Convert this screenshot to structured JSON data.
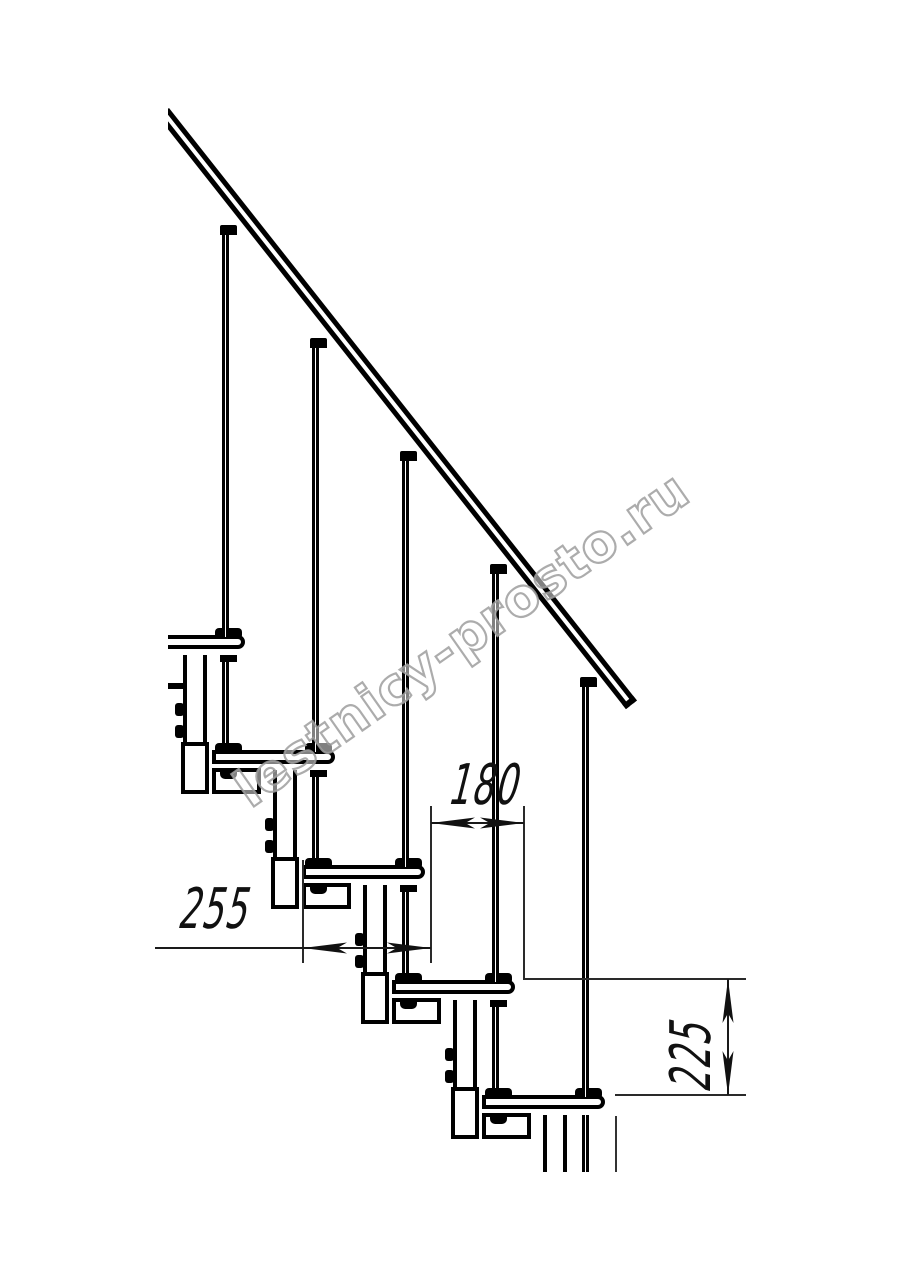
{
  "watermark": {
    "text": "lestnicy-prosto.ru",
    "stroke_color": "#9e9e9e"
  },
  "drawing": {
    "type": "modular-staircase-side-elevation",
    "background": "#ffffff",
    "line_color": "#000000",
    "dim_color": "#1a1a1a",
    "tread_count": 5,
    "baluster_count": 5,
    "dimensions": {
      "tread_length": {
        "value": "255",
        "orientation": "horizontal"
      },
      "step_going": {
        "value": "180",
        "orientation": "horizontal"
      },
      "step_rise": {
        "value": "225",
        "orientation": "vertical"
      }
    }
  }
}
